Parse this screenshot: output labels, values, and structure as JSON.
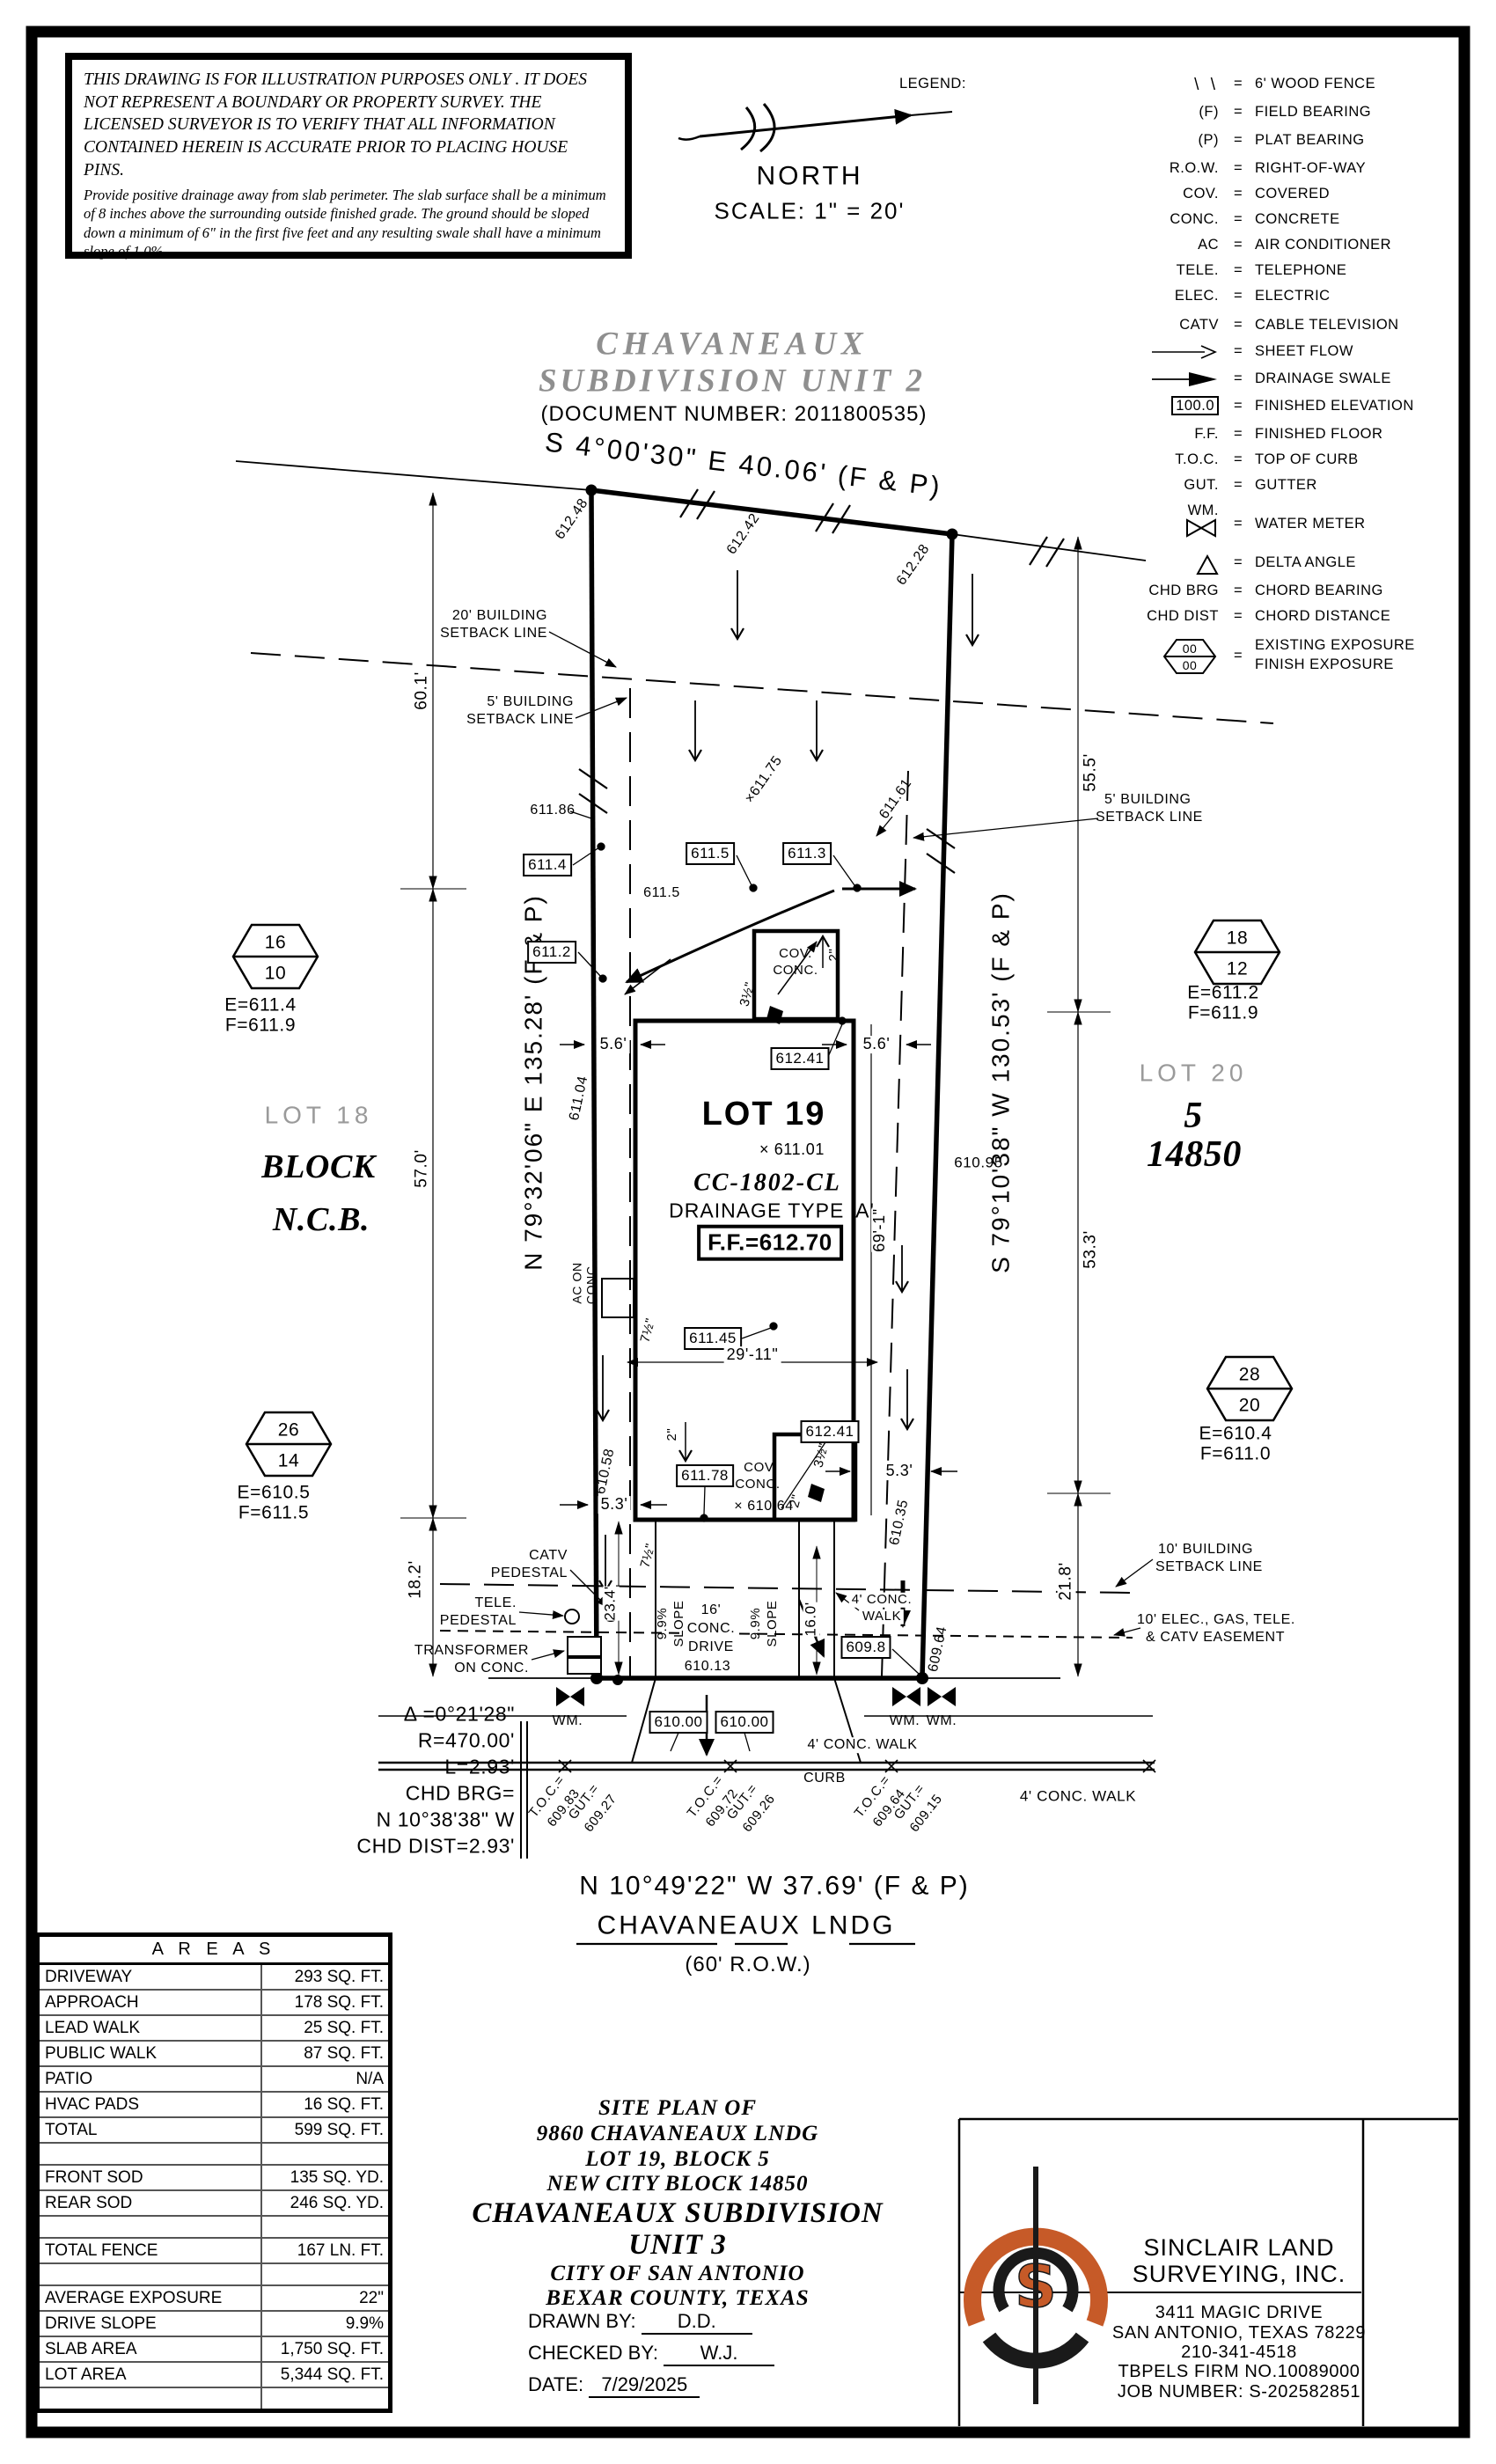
{
  "disclaimer": {
    "para1": "THIS DRAWING IS FOR ILLUSTRATION PURPOSES ONLY . IT DOES NOT REPRESENT A BOUNDARY OR PROPERTY SURVEY. THE LICENSED SURVEYOR IS TO VERIFY THAT ALL INFORMATION CONTAINED HEREIN IS ACCURATE PRIOR TO PLACING HOUSE PINS.",
    "para2": "Provide positive drainage away from slab perimeter. The slab surface shall be a minimum of 8 inches above the surrounding outside finished grade. The ground should be sloped down a minimum of 6\" in the first five feet and any resulting swale shall have a minimum slope of 1.0%."
  },
  "north": {
    "label": "NORTH",
    "scale": "SCALE:  1\" = 20'"
  },
  "header": {
    "title1": "CHAVANEAUX",
    "title2": "SUBDIVISION  UNIT  2",
    "doc": "(DOCUMENT NUMBER:  2011800535)"
  },
  "legend": {
    "title": "LEGEND:",
    "eq": "=",
    "items": [
      {
        "sym": "\\ \\",
        "text": "6' WOOD FENCE"
      },
      {
        "sym": "(F)",
        "text": "FIELD BEARING"
      },
      {
        "sym": "(P)",
        "text": "PLAT BEARING"
      },
      {
        "sym": "R.O.W.",
        "text": "RIGHT-OF-WAY"
      },
      {
        "sym": "COV.",
        "text": "COVERED"
      },
      {
        "sym": "CONC.",
        "text": "CONCRETE"
      },
      {
        "sym": "AC",
        "text": "AIR CONDITIONER"
      },
      {
        "sym": "TELE.",
        "text": "TELEPHONE"
      },
      {
        "sym": "ELEC.",
        "text": "ELECTRIC"
      },
      {
        "sym": "CATV",
        "text": "CABLE TELEVISION"
      },
      {
        "sym": "",
        "text": "SHEET FLOW"
      },
      {
        "sym": "",
        "text": "DRAINAGE SWALE"
      },
      {
        "sym": "100.0",
        "text": "FINISHED ELEVATION"
      },
      {
        "sym": "F.F.",
        "text": "FINISHED FLOOR"
      },
      {
        "sym": "T.O.C.",
        "text": "TOP OF CURB"
      },
      {
        "sym": "GUT.",
        "text": "GUTTER"
      },
      {
        "sym": "WM.",
        "text": "WATER METER"
      },
      {
        "sym": "",
        "text": "DELTA ANGLE"
      },
      {
        "sym": "CHD BRG",
        "text": "CHORD BEARING"
      },
      {
        "sym": "CHD DIST",
        "text": "CHORD DISTANCE"
      },
      {
        "sym": "00",
        "sym2": "00",
        "text": "EXISTING EXPOSURE",
        "text2": "FINISH EXPOSURE"
      }
    ]
  },
  "plan": {
    "bearing_top": "S 4°00'30\" E 40.06' (F & P)",
    "bearing_left": "N 79°32'06\" E 135.28' (F & P)",
    "bearing_right": "S 79°10'38\" W 130.53' (F & P)",
    "bearing_bottom": "N 10°49'22\" W 37.69' (F & P)",
    "street_name": "CHAVANEAUX LNDG",
    "street_row": "(60' R.O.W.)",
    "curb": "CURB",
    "walk_street": "4' CONC. WALK",
    "walk_side1": "4' CONC.",
    "walk_side2": "WALK",
    "drive1": "16'",
    "drive2": "CONC.",
    "drive3": "DRIVE",
    "drive_spot": "610.13",
    "slope": "9.9%",
    "slope_word": "SLOPE",
    "sb20a": "20' BUILDING",
    "sb20b": "SETBACK LINE",
    "sb5a": "5' BUILDING",
    "sb5b": "SETBACK LINE",
    "sb10a": "10' BUILDING",
    "sb10b": "SETBACK LINE",
    "easea": "10' ELEC., GAS, TELE.",
    "easeb": "& CATV EASEMENT",
    "lot18": "LOT 18",
    "block_word": "BLOCK",
    "ncb_word": "N.C.B.",
    "lot20": "LOT 20",
    "block_num": "5",
    "ncb_num": "14850",
    "lot19": "LOT 19",
    "spot_lot19": "× 611.01",
    "code": "CC-1802-CL",
    "drainage": "DRAINAGE  TYPE  'A'",
    "ff": "F.F.=612.70",
    "cov": "COV.",
    "conc": "CONC.",
    "ac1": "AC ON",
    "ac2": "CONC.",
    "catv1": "CATV",
    "catv2": "PEDESTAL",
    "tele1": "TELE.",
    "tele2": "PEDESTAL",
    "xf1": "TRANSFORMER",
    "xf2": "ON CONC.",
    "wm": "WM.",
    "hex": [
      {
        "top": "16",
        "bot": "10",
        "e": "E=611.4",
        "f": "F=611.9"
      },
      {
        "top": "18",
        "bot": "12",
        "e": "E=611.2",
        "f": "F=611.9"
      },
      {
        "top": "26",
        "bot": "14",
        "e": "E=610.5",
        "f": "F=611.5"
      },
      {
        "top": "28",
        "bot": "20",
        "e": "E=610.4",
        "f": "F=611.0"
      }
    ],
    "boxed": [
      "611.4",
      "611.2",
      "611.5",
      "611.3",
      "612.41",
      "611.45",
      "611.78",
      "612.41",
      "609.8",
      "610.00",
      "610.00"
    ],
    "spot": [
      "611.86",
      "611.5",
      "×611.75",
      "611.61",
      "612.48",
      "612.42",
      "612.28",
      "611.04",
      "610.58",
      "610.95",
      "610.35",
      "609.64",
      "× 610.64"
    ],
    "dim": {
      "d60": "60.1'",
      "d57": "57.0'",
      "d18": "18.2'",
      "d55": "55.5'",
      "d53": "53.3'",
      "d21": "21.8'",
      "d56": "5.6'",
      "d53b": "5.3'",
      "d23": "23.4'",
      "d16": "16.0'",
      "d29": "29'-11\"",
      "d69": "69'-1\"",
      "d7": "7½\"",
      "d2": "2\"",
      "d3": "3½\""
    },
    "curve": {
      "l1": "Δ =0°21'28\"",
      "l2": "R=470.00'",
      "l3": "L=2.93'",
      "l4": "CHD BRG=",
      "l5": "N 10°38'38\" W",
      "l6": "CHD DIST=2.93'"
    },
    "toc": [
      {
        "a": "T.O.C.=",
        "b": "609.83",
        "c": "GUT.=",
        "d": "609.27"
      },
      {
        "a": "T.O.C.=",
        "b": "609.72",
        "c": "GUT.=",
        "d": "609.26"
      },
      {
        "a": "T.O.C.=",
        "b": "609.64",
        "c": "GUT.=",
        "d": "609.15"
      }
    ]
  },
  "areas": {
    "title": "A R E A S",
    "rows": [
      [
        "DRIVEWAY",
        "293 SQ. FT."
      ],
      [
        "APPROACH",
        "178 SQ. FT."
      ],
      [
        "LEAD WALK",
        "25 SQ. FT."
      ],
      [
        "PUBLIC WALK",
        "87 SQ. FT."
      ],
      [
        "PATIO",
        "N/A"
      ],
      [
        "HVAC PADS",
        "16 SQ. FT."
      ],
      [
        "TOTAL",
        "599 SQ. FT."
      ],
      [
        "",
        ""
      ],
      [
        "FRONT SOD",
        "135 SQ. YD."
      ],
      [
        "REAR SOD",
        "246 SQ. YD."
      ],
      [
        "",
        ""
      ],
      [
        "TOTAL FENCE",
        "167 LN. FT."
      ],
      [
        "",
        ""
      ],
      [
        "AVERAGE EXPOSURE",
        "22\""
      ],
      [
        "DRIVE SLOPE",
        "9.9%"
      ],
      [
        "SLAB AREA",
        "1,750 SQ. FT."
      ],
      [
        "LOT AREA",
        "5,344 SQ. FT."
      ],
      [
        "",
        ""
      ]
    ]
  },
  "titleblock": {
    "l1": "SITE PLAN OF",
    "l2": "9860 CHAVANEAUX LNDG",
    "l3": "LOT 19, BLOCK 5",
    "l4": "NEW CITY BLOCK 14850",
    "l5": "CHAVANEAUX SUBDIVISION",
    "l6": "UNIT 3",
    "l7": "CITY OF SAN ANTONIO",
    "l8": "BEXAR COUNTY, TEXAS",
    "drawn_label": "DRAWN BY:",
    "drawn": "D.D.",
    "checked_label": "CHECKED BY:",
    "checked": "W.J.",
    "date_label": "DATE:",
    "date": "7/29/2025"
  },
  "company": {
    "name1": "SINCLAIR  LAND",
    "name2": "SURVEYING,  INC.",
    "addr1": "3411 MAGIC DRIVE",
    "addr2": "SAN ANTONIO, TEXAS 78229",
    "phone": "210-341-4518",
    "firm": "TBPELS FIRM NO.10089000",
    "job": "JOB NUMBER: S-202582851",
    "logo_letter": "S",
    "accent": "#c65a28"
  }
}
